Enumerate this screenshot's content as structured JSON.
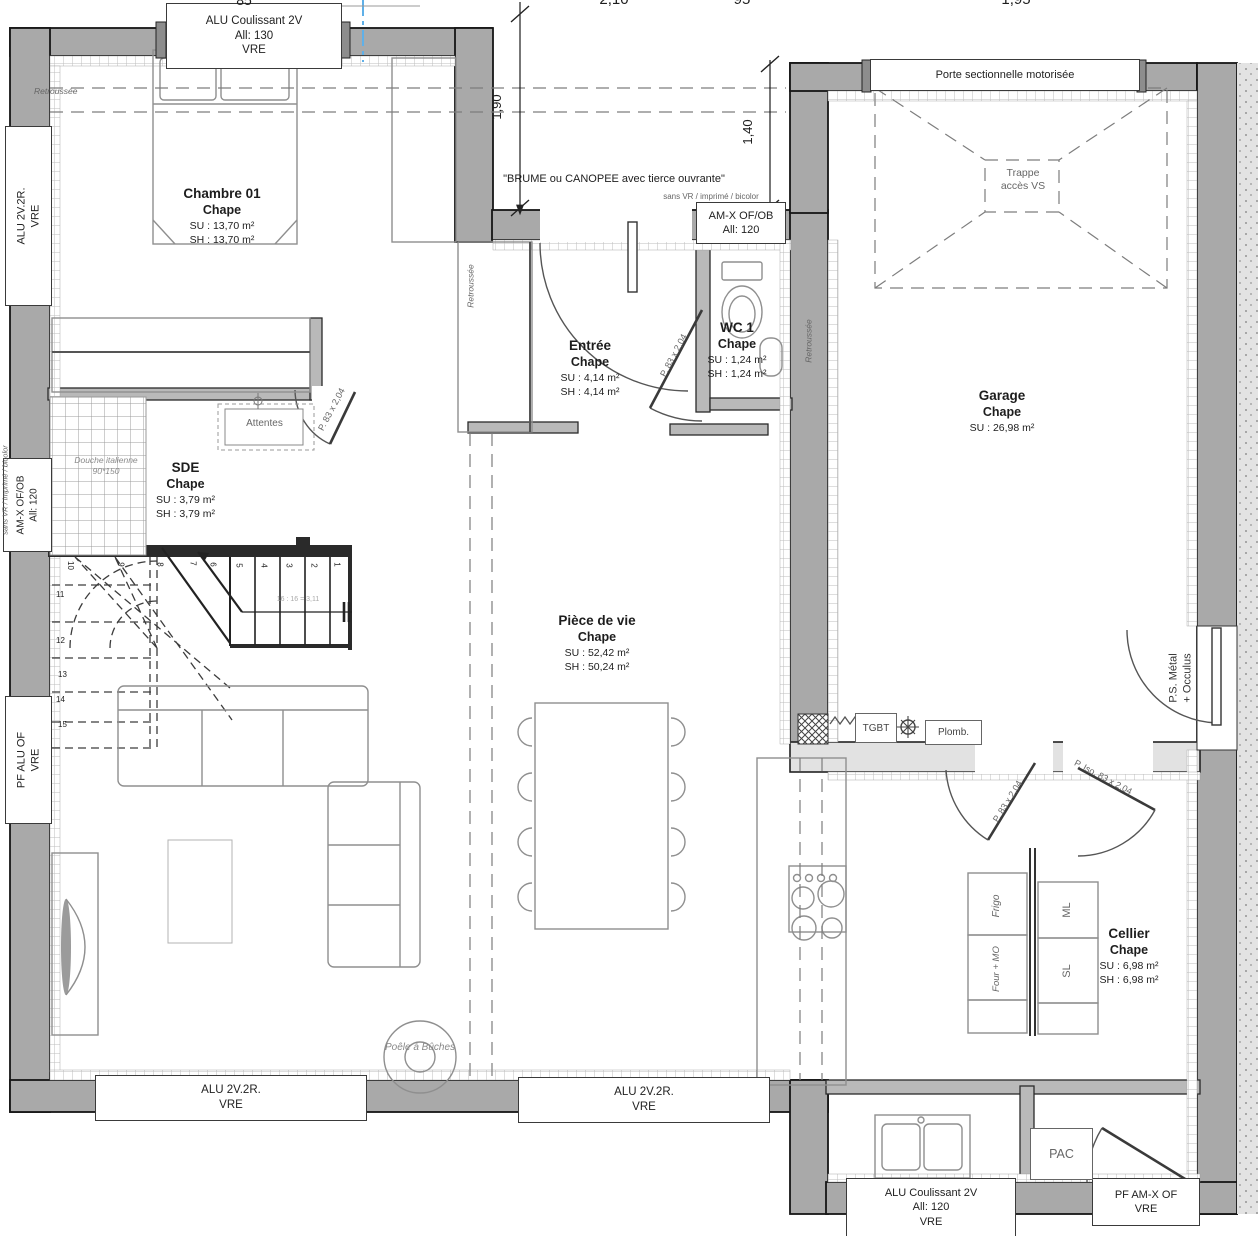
{
  "dimensions": {
    "top": [
      "85",
      "2,10",
      "95",
      "1,95"
    ],
    "v1": "1,90",
    "v2": "1,40"
  },
  "rooms": {
    "chambre": {
      "name": "Chambre 01",
      "finish": "Chape",
      "su": "SU : 13,70 m²",
      "sh": "SH : 13,70 m²"
    },
    "entree": {
      "name": "Entrée",
      "finish": "Chape",
      "su": "SU : 4,14 m²",
      "sh": "SH : 4,14 m²"
    },
    "wc": {
      "name": "WC 1",
      "finish": "Chape",
      "su": "SU : 1,24 m²",
      "sh": "SH : 1,24 m²"
    },
    "garage": {
      "name": "Garage",
      "finish": "Chape",
      "su": "SU : 26,98 m²"
    },
    "sde": {
      "name": "SDE",
      "finish": "Chape",
      "su": "SU : 3,79 m²",
      "sh": "SH : 3,79 m²"
    },
    "piece_de_vie": {
      "name": "Pièce de vie",
      "finish": "Chape",
      "su": "SU : 52,42 m²",
      "sh": "SH : 50,24 m²"
    },
    "cellier": {
      "name": "Cellier",
      "finish": "Chape",
      "su": "SU : 6,98 m²",
      "sh": "SH : 6,98 m²"
    }
  },
  "windows": {
    "chambre_top": [
      "ALU Coulissant 2V",
      "All: 130",
      "VRE"
    ],
    "chambre_left": [
      "ALU 2V.2R.",
      "VRE"
    ],
    "sde_left": [
      "AM-X OF/OB",
      "All: 120"
    ],
    "living_left": [
      "PF ALU OF",
      "VRE"
    ],
    "entry": [
      "AM-X OF/OB",
      "All: 120"
    ],
    "garage_door": "Porte sectionnelle motorisée",
    "garage_side_door": [
      "P.S. Métal",
      "+ Occulus"
    ],
    "living_bottom_left": [
      "ALU 2V.2R.",
      "VRE"
    ],
    "living_bottom_right": [
      "ALU 2V.2R.",
      "VRE"
    ],
    "annex_bottom": [
      "ALU Coulissant 2V",
      "All: 120",
      "VRE"
    ],
    "annex_pf": [
      "PF AM-X OF",
      "VRE"
    ]
  },
  "annotations": {
    "retroussee": "Retroussée",
    "brume": "\"BRUME ou CANOPEE avec tierce ouvrante\"",
    "sans_vr": "sans VR / imprimé / bicolor",
    "trappe": [
      "Trappe",
      "accès VS"
    ],
    "attentes": "Attentes",
    "douche": [
      "Douche italienne",
      "90*150"
    ],
    "door_p83": "P. 83 x 2,04",
    "door_iso": "P. Iso. 83 x 2,04",
    "tgbt": "TGBT",
    "plomb": "Plomb.",
    "pac": "PAC",
    "poele": "Poêle à Bûches",
    "frigo": "Frigo",
    "four_mo": "Four + MO",
    "ml": "ML",
    "sl": "SL",
    "stair_note": "16 : 16 = 3,11"
  },
  "stairs": {
    "treads": [
      "1",
      "2",
      "3",
      "4",
      "5",
      "6",
      "7",
      "8",
      "9",
      "10",
      "11",
      "12",
      "13",
      "14",
      "15"
    ]
  }
}
